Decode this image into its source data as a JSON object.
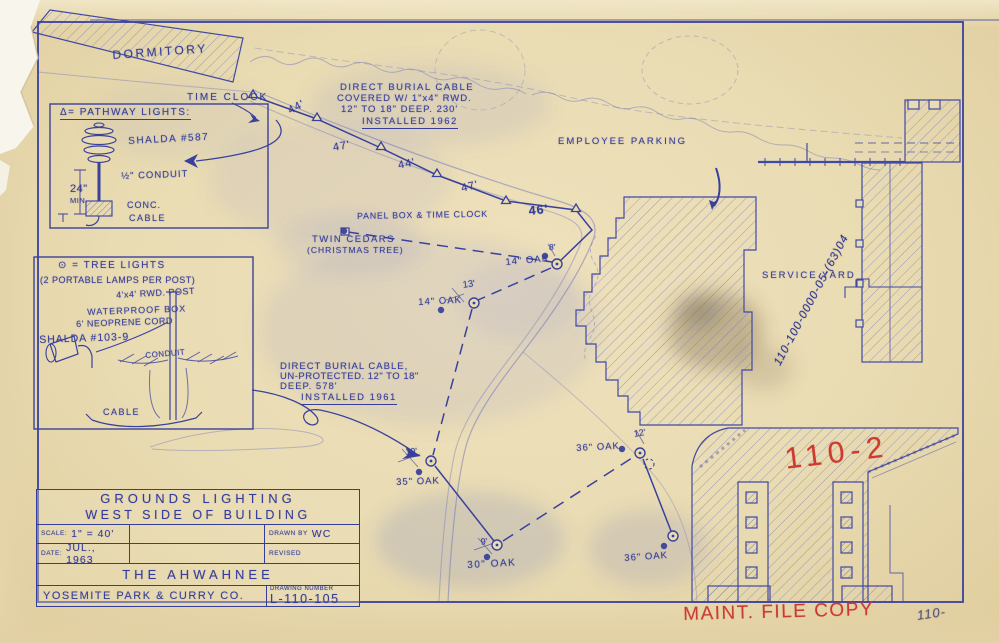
{
  "colors": {
    "paper": "#e9dbb2",
    "ink": "#3a419c",
    "ink_faded": "#6a72bb",
    "red": "#cd3a31",
    "pencil": "#595372"
  },
  "title_block": {
    "line1": "GROUNDS  LIGHTING",
    "line2": "WEST  SIDE  OF  BUILDING",
    "scale_label": "SCALE:",
    "scale_value": "1\" = 40'",
    "date_label": "DATE:",
    "date_value": "JUL., 1963",
    "drawn_label": "DRAWN BY",
    "drawn_value": "WC",
    "revised_label": "REVISED",
    "revised_value": "",
    "project": "THE  AHWAHNEE",
    "company": "YOSEMITE PARK & CURRY CO.",
    "number_label": "DRAWING NUMBER",
    "number_value": "L-110-105"
  },
  "map_labels": [
    {
      "id": "dormitory",
      "t": "DORMITORY",
      "x": 112,
      "y": 48,
      "s": 12,
      "r": -4,
      "ls": 2.5
    },
    {
      "id": "time-clock",
      "t": "TIME CLOCK",
      "x": 187,
      "y": 92,
      "s": 10,
      "r": 0,
      "ls": 2
    },
    {
      "id": "note1-line1",
      "t": "DIRECT BURIAL CABLE",
      "x": 340,
      "y": 82,
      "s": 9.5,
      "r": 0,
      "ls": 1.5
    },
    {
      "id": "note1-line2",
      "t": "COVERED W/ 1\"x4\" RWD.",
      "x": 337,
      "y": 93,
      "s": 9.5,
      "r": 0,
      "ls": 1
    },
    {
      "id": "note1-line3",
      "t": "12\" TO 18\" DEEP.  230'",
      "x": 341,
      "y": 104,
      "s": 9.5,
      "r": 0,
      "ls": 1
    },
    {
      "id": "note1-line4",
      "t": "INSTALLED 1962",
      "x": 362,
      "y": 116,
      "s": 9.5,
      "r": 0,
      "ls": 1.5,
      "u": true
    },
    {
      "id": "employee-parking",
      "t": "EMPLOYEE  PARKING",
      "x": 558,
      "y": 136,
      "s": 9.5,
      "r": 0,
      "ls": 2
    },
    {
      "id": "meas-44a",
      "t": "44'",
      "x": 286,
      "y": 106,
      "s": 11,
      "r": -28,
      "ls": 1
    },
    {
      "id": "meas-47a",
      "t": "47'",
      "x": 332,
      "y": 142,
      "s": 11,
      "r": -10,
      "ls": 1
    },
    {
      "id": "meas-44b",
      "t": "44'",
      "x": 397,
      "y": 160,
      "s": 11,
      "r": -12,
      "ls": 1
    },
    {
      "id": "meas-47b",
      "t": "47'",
      "x": 460,
      "y": 183,
      "s": 11,
      "r": -14,
      "ls": 1
    },
    {
      "id": "meas-46",
      "t": "46'",
      "x": 528,
      "y": 204,
      "s": 12.5,
      "r": -6,
      "ls": 1,
      "w": true
    },
    {
      "id": "panel-box",
      "t": "PANEL BOX & TIME CLOCK",
      "x": 357,
      "y": 211,
      "s": 8.8,
      "r": -1,
      "ls": 0.8
    },
    {
      "id": "twin-cedars-1",
      "t": "TWIN CEDARS",
      "x": 312,
      "y": 234,
      "s": 9.5,
      "r": 0,
      "ls": 1.5
    },
    {
      "id": "twin-cedars-2",
      "t": "(CHRISTMAS TREE)",
      "x": 307,
      "y": 245,
      "s": 8.5,
      "r": 0,
      "ls": 1
    },
    {
      "id": "oak-14a",
      "t": "14\" OAK",
      "x": 505,
      "y": 257,
      "s": 9.5,
      "r": -5,
      "ls": 1
    },
    {
      "id": "meas-8",
      "t": "8'",
      "x": 549,
      "y": 242,
      "s": 8.5,
      "r": 0,
      "ls": 0
    },
    {
      "id": "meas-13",
      "t": "13'",
      "x": 462,
      "y": 280,
      "s": 9.5,
      "r": -8,
      "ls": 0
    },
    {
      "id": "oak-14b",
      "t": "14\" OAK",
      "x": 418,
      "y": 297,
      "s": 9.5,
      "r": -3,
      "ls": 1
    },
    {
      "id": "note2-line1",
      "t": "DIRECT BURIAL CABLE,",
      "x": 280,
      "y": 361,
      "s": 9.5,
      "r": 0,
      "ls": 1
    },
    {
      "id": "note2-line2",
      "t": "UN-PROTECTED.  12\" TO 18\"",
      "x": 280,
      "y": 371,
      "s": 9.5,
      "r": 0,
      "ls": 0.5
    },
    {
      "id": "note2-line3",
      "t": "DEEP.   578'",
      "x": 280,
      "y": 381,
      "s": 9.5,
      "r": 0,
      "ls": 1
    },
    {
      "id": "note2-line4",
      "t": "INSTALLED  1961",
      "x": 301,
      "y": 392,
      "s": 9.5,
      "r": 0,
      "ls": 1.5,
      "u": true
    },
    {
      "id": "meas-10",
      "t": "10'",
      "x": 405,
      "y": 447,
      "s": 9,
      "r": -5,
      "ls": 0
    },
    {
      "id": "oak-35",
      "t": "35\" OAK",
      "x": 396,
      "y": 477,
      "s": 9.5,
      "r": -2,
      "ls": 1
    },
    {
      "id": "oak-36-top",
      "t": "36\" OAK",
      "x": 576,
      "y": 443,
      "s": 9.5,
      "r": -3,
      "ls": 1
    },
    {
      "id": "meas-12",
      "t": "12'",
      "x": 633,
      "y": 429,
      "s": 9,
      "r": -10,
      "ls": 0
    },
    {
      "id": "meas-9",
      "t": "9'",
      "x": 480,
      "y": 537,
      "s": 9,
      "r": -8,
      "ls": 0
    },
    {
      "id": "oak-30",
      "t": "30\" OAK",
      "x": 467,
      "y": 560,
      "s": 10,
      "r": -3,
      "ls": 1.5
    },
    {
      "id": "oak-36-bottom",
      "t": "36\" OAK",
      "x": 624,
      "y": 553,
      "s": 9.5,
      "r": -4,
      "ls": 1
    },
    {
      "id": "service-yard",
      "t": "SERVICE  YARD",
      "x": 762,
      "y": 270,
      "s": 9.5,
      "r": 0,
      "ls": 2
    },
    {
      "id": "file-number",
      "t": "110-100-0000-05-(63)04",
      "x": 772,
      "y": 362,
      "s": 11.5,
      "r": -62,
      "ls": 1,
      "c": "pen"
    },
    {
      "id": "red-code",
      "t": "110-2",
      "x": 783,
      "y": 443,
      "s": 30,
      "r": -7,
      "ls": 6,
      "c": "red"
    },
    {
      "id": "red-stamp",
      "t": "MAINT. FILE COPY",
      "x": 683,
      "y": 604,
      "s": 19,
      "r": -1.5,
      "ls": 1.5,
      "c": "red"
    },
    {
      "id": "pencil-110",
      "t": "110-",
      "x": 916,
      "y": 608,
      "s": 13,
      "r": -8,
      "ls": 1,
      "c": "pencil"
    },
    {
      "id": "legend1-title",
      "t": "Δ= PATHWAY  LIGHTS:",
      "x": 60,
      "y": 107,
      "s": 10,
      "r": 0,
      "ls": 1.5,
      "u": true
    },
    {
      "id": "legend1-shalda",
      "t": "SHALDA #587",
      "x": 128,
      "y": 136,
      "s": 10,
      "r": -3,
      "ls": 1.5
    },
    {
      "id": "legend1-conduit",
      "t": "½\" CONDUIT",
      "x": 121,
      "y": 171,
      "s": 9.5,
      "r": -2,
      "ls": 1
    },
    {
      "id": "legend1-24",
      "t": "24\"",
      "x": 70,
      "y": 183,
      "s": 11,
      "r": 0,
      "ls": 0.5
    },
    {
      "id": "legend1-min",
      "t": "MIN.",
      "x": 70,
      "y": 196,
      "s": 7.5,
      "r": 0,
      "ls": 0.5
    },
    {
      "id": "legend1-conc",
      "t": "CONC.",
      "x": 127,
      "y": 200,
      "s": 9,
      "r": 0,
      "ls": 1
    },
    {
      "id": "legend1-cable",
      "t": "CABLE",
      "x": 129,
      "y": 213,
      "s": 9,
      "r": 0,
      "ls": 1.5
    },
    {
      "id": "legend2-title",
      "t": "⊙ = TREE  LIGHTS",
      "x": 58,
      "y": 260,
      "s": 10,
      "r": 0,
      "ls": 1.5
    },
    {
      "id": "legend2-sub",
      "t": "(2 PORTABLE LAMPS PER POST)",
      "x": 40,
      "y": 275,
      "s": 9,
      "r": 0,
      "ls": 0.5
    },
    {
      "id": "legend2-post",
      "t": "4'x4' RWD. POST",
      "x": 116,
      "y": 290,
      "s": 9,
      "r": -3,
      "ls": 0.5
    },
    {
      "id": "legend2-box",
      "t": "WATERPROOF BOX",
      "x": 87,
      "y": 307,
      "s": 9,
      "r": -2,
      "ls": 1
    },
    {
      "id": "legend2-cord",
      "t": "6' NEOPRENE CORD",
      "x": 76,
      "y": 319,
      "s": 9,
      "r": -2,
      "ls": 0.5
    },
    {
      "id": "legend2-shalda",
      "t": "SHALDA #103-9",
      "x": 39,
      "y": 334,
      "s": 10.5,
      "r": -2,
      "ls": 1
    },
    {
      "id": "legend2-conduit",
      "t": "CONDUIT",
      "x": 145,
      "y": 351,
      "s": 8,
      "r": -5,
      "ls": 0.5
    },
    {
      "id": "legend2-cable",
      "t": "CABLE",
      "x": 103,
      "y": 407,
      "s": 9,
      "r": 0,
      "ls": 1.5
    }
  ],
  "symbols": {
    "path_lights": [
      [
        253,
        94
      ],
      [
        317,
        117
      ],
      [
        381,
        146
      ],
      [
        437,
        173
      ],
      [
        506,
        200
      ],
      [
        576,
        208
      ]
    ],
    "tree_lights": [
      [
        557,
        264
      ],
      [
        474,
        303
      ],
      [
        431,
        461
      ],
      [
        497,
        545
      ],
      [
        640,
        453
      ],
      [
        673,
        536
      ]
    ],
    "tree_lights_dashed": [
      [
        649,
        464
      ]
    ],
    "trees": [
      [
        545,
        256
      ],
      [
        441,
        310
      ],
      [
        419,
        472
      ],
      [
        622,
        449
      ],
      [
        487,
        557
      ],
      [
        664,
        546
      ],
      [
        344,
        231
      ]
    ]
  }
}
